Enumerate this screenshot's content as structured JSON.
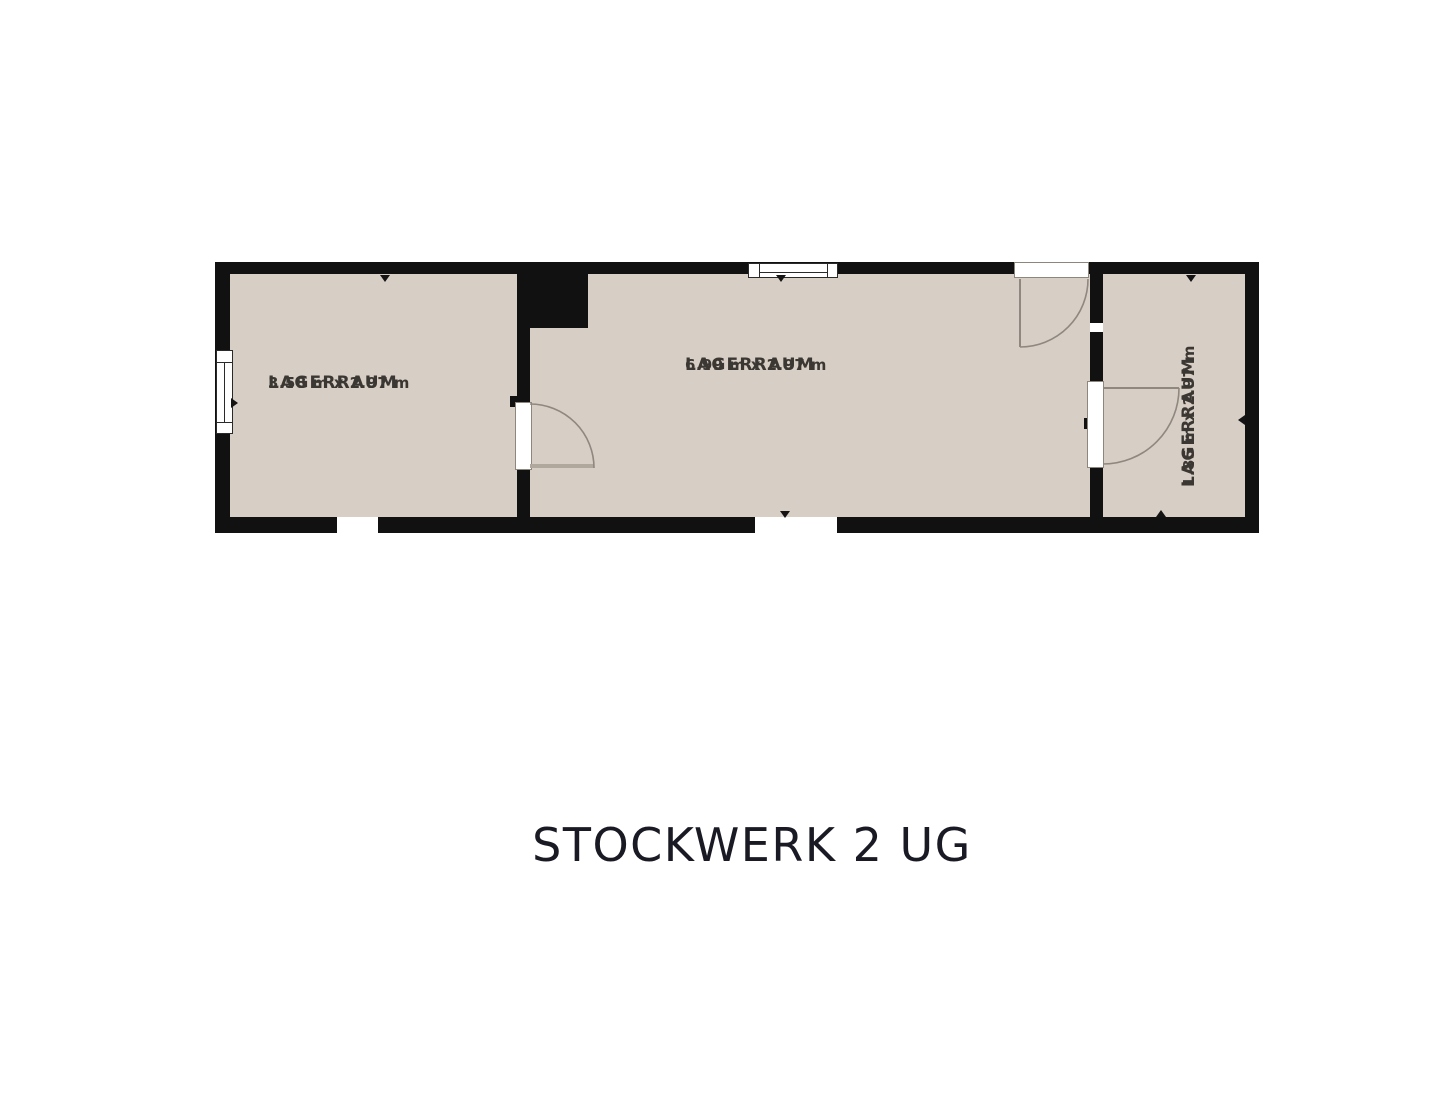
{
  "floorplan": {
    "title": "STOCKWERK 2 UG",
    "rooms": [
      {
        "name": "LAGERRAUM",
        "dims": "3.58 m x 2.97 m"
      },
      {
        "name": "LAGERRAUM",
        "dims": "6.99 m x 2.97 m"
      },
      {
        "name": "LAGERRAUM",
        "dims": "1.85 m x 2.97 m"
      }
    ],
    "colors": {
      "background": "#ffffff",
      "floor": "#d7cec5",
      "wall": "#111111",
      "door_arc": "#8f8880",
      "door_leaf": "#b0a89d",
      "window": "#ffffff",
      "label_text": "#3b3733",
      "title_text": "#1a1a24"
    }
  }
}
